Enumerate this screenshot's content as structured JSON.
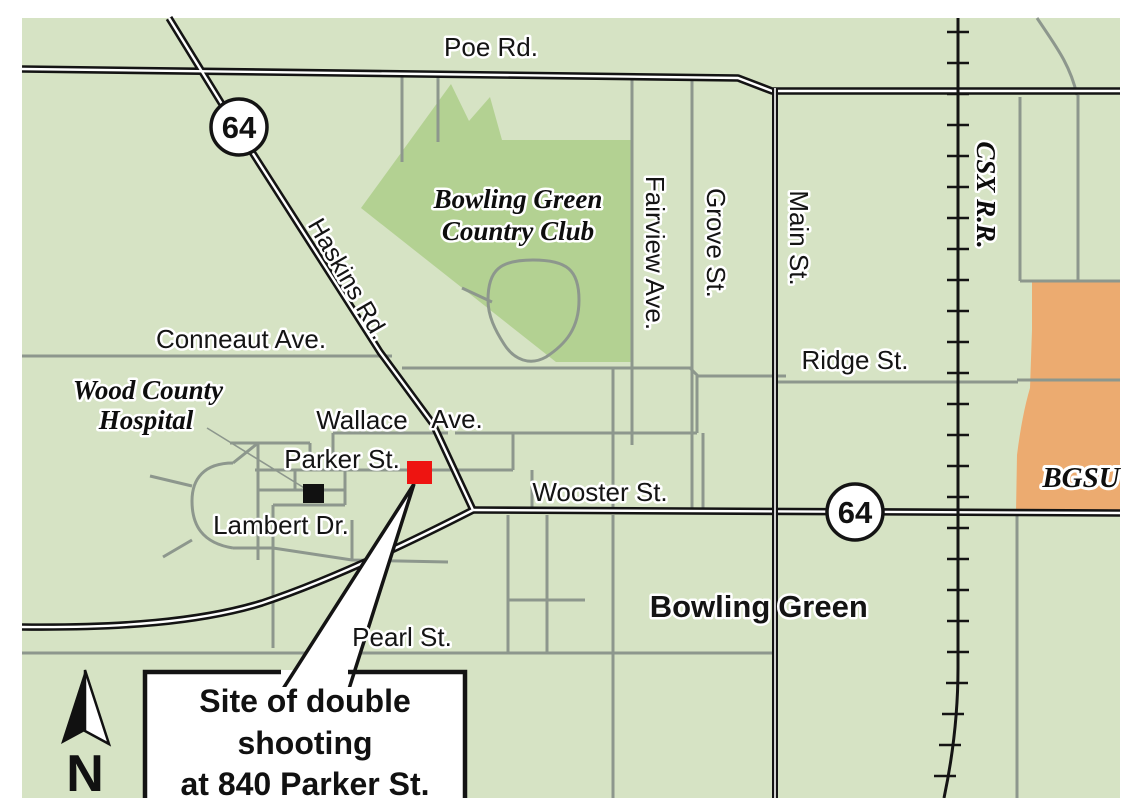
{
  "map": {
    "street_labels": {
      "poe": "Poe Rd.",
      "conneaut": "Conneaut  Ave.",
      "haskins": "Haskins Rd.",
      "wallace": "Wallace",
      "wallace_ave": "Ave.",
      "parker": "Parker St.",
      "lambert": "Lambert  Dr.",
      "pearl": "Pearl St.",
      "wooster": "Wooster St.",
      "ridge": "Ridge St.",
      "fairview": "Fairview Ave.",
      "grove": "Grove St.",
      "main": "Main St.",
      "railroad": "CSX R.R."
    },
    "region_labels": {
      "country_club_line1": "Bowling Green",
      "country_club_line2": "Country Club",
      "hospital_line1": "Wood County",
      "hospital_line2": "Hospital",
      "campus": "BGSU",
      "city_line1": "Bowling",
      "city_line2": "Green"
    },
    "route_shields": [
      {
        "number": "64"
      },
      {
        "number": "64"
      }
    ],
    "callout": {
      "line1": "Site of double",
      "line2": "shooting",
      "line3": "at 840 Parker St."
    },
    "compass": {
      "label": "N"
    },
    "colors": {
      "land": "#d6e3c4",
      "country_club": "#b3d192",
      "campus": "#ecab70",
      "minor_road": "#8d978d",
      "major_road": "#141414",
      "site_marker": "#ee1411",
      "hospital_marker": "#111111",
      "shield_fill": "#ffffff",
      "callout_bg": "#ffffff"
    }
  }
}
